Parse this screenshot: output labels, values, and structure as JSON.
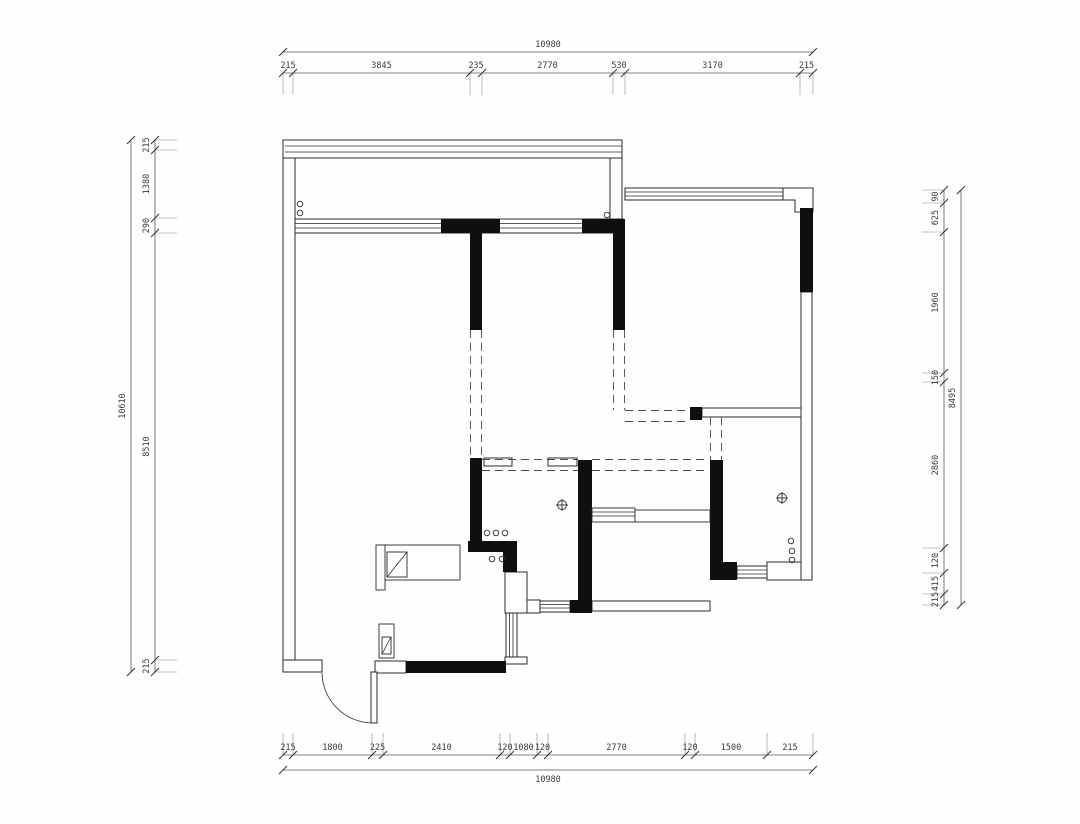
{
  "document": {
    "kind": "architectural-floor-plan",
    "units": "mm"
  },
  "dimensions": {
    "top": {
      "total": "10980",
      "segments": [
        "215",
        "3845",
        "235",
        "2770",
        "530",
        "3170",
        "215"
      ]
    },
    "bottom": {
      "total": "10980",
      "segments": [
        "215",
        "1800",
        "225",
        "2410",
        "120",
        "1080",
        "120",
        "2770",
        "120",
        "1500",
        "215"
      ]
    },
    "left": {
      "total": "10610",
      "segments": [
        "215",
        "1380",
        "290",
        "8510",
        "215"
      ]
    },
    "right": {
      "total": "8495",
      "segments": [
        "90",
        "625",
        "1960",
        "150",
        "2860",
        "120",
        "415",
        "215"
      ]
    }
  },
  "symbols": {
    "ceiling_fixture": "circled-cross",
    "hinge_dots": "small-circles"
  }
}
